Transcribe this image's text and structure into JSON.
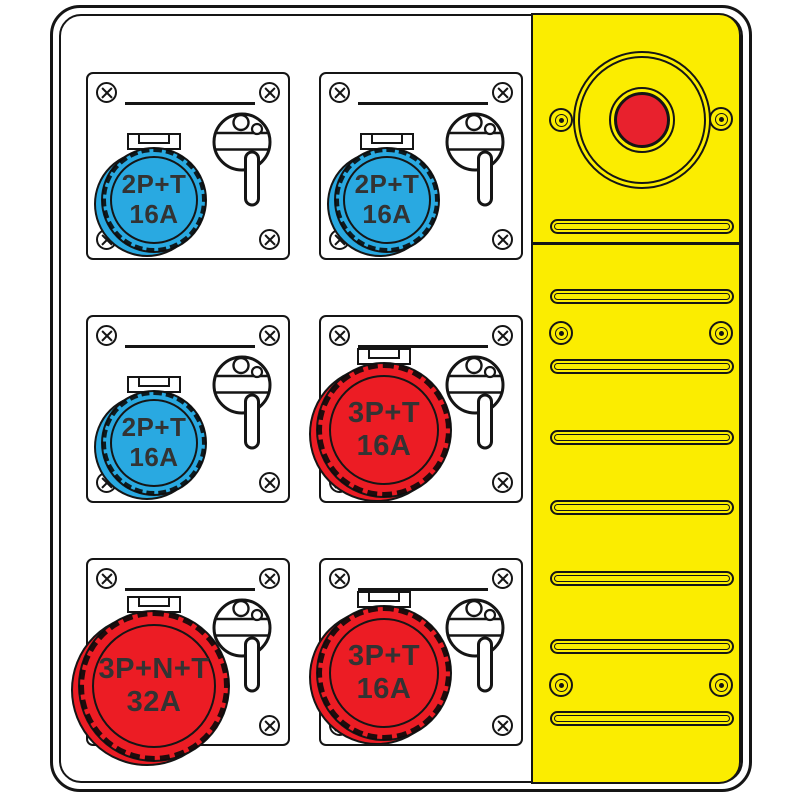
{
  "illustration": {
    "title": "Power distribution board with CEE sockets and emergency stop",
    "type": "technical-line-drawing"
  },
  "colors": {
    "socket_blue": "#29A9E1",
    "socket_red": "#EC1C24",
    "panel_yellow": "#FBED00",
    "button_red": "#E8212D",
    "outline": "#151515",
    "label_text": "#333333"
  },
  "modules": [
    {
      "position": "top-left",
      "socket_color": "blue",
      "line1": "2P+T",
      "line2": "16A"
    },
    {
      "position": "top-right",
      "socket_color": "blue",
      "line1": "2P+T",
      "line2": "16A"
    },
    {
      "position": "middle-left",
      "socket_color": "blue",
      "line1": "2P+T",
      "line2": "16A"
    },
    {
      "position": "middle-right",
      "socket_color": "red",
      "line1": "3P+T",
      "line2": "16A"
    },
    {
      "position": "bottom-left",
      "socket_color": "red",
      "line1": "3P+N+T",
      "line2": "32A"
    },
    {
      "position": "bottom-right",
      "socket_color": "red",
      "line1": "3P+T",
      "line2": "16A"
    }
  ],
  "side_panel": {
    "emergency_stop": {
      "label": "emergency stop button"
    },
    "vent_slot_count": 8,
    "rivet_pair_count": 3
  }
}
